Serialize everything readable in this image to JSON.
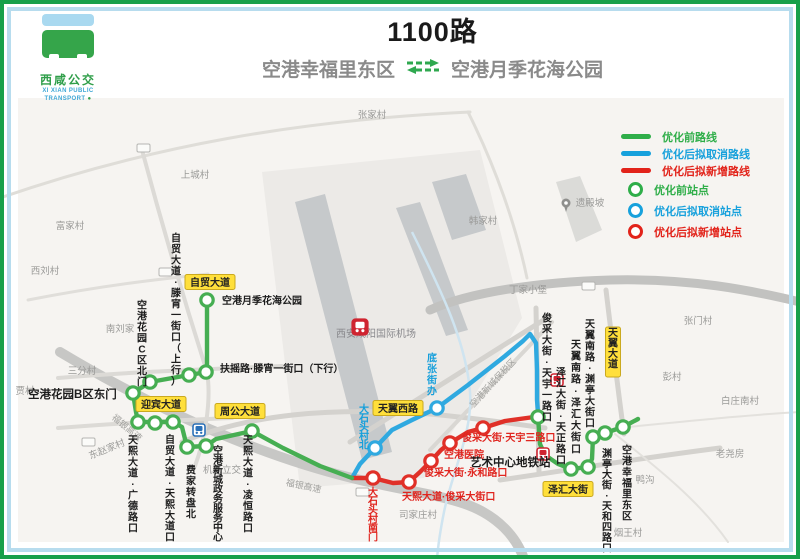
{
  "header": {
    "title": "1100路",
    "from": "空港幸福里东区",
    "to": "空港月季花海公园",
    "arrow_icon": "double-arrow-icon",
    "logo": {
      "cn": "西咸公交",
      "en_line1": "XI XIAN PUBLIC",
      "en_line2": "TRANSPORT"
    }
  },
  "legend": {
    "items": [
      {
        "type": "line",
        "color": "#2fae49",
        "label": "优化前路线"
      },
      {
        "type": "line",
        "color": "#17a1dc",
        "label": "优化后拟取消路线"
      },
      {
        "type": "line",
        "color": "#e2231a",
        "label": "优化后拟新增路线"
      },
      {
        "type": "stop",
        "color": "#2fae49",
        "label": "优化前站点"
      },
      {
        "type": "stop",
        "color": "#17a1dc",
        "label": "优化后拟取消站点"
      },
      {
        "type": "stop",
        "color": "#e2231a",
        "label": "优化后拟新增站点"
      }
    ]
  },
  "map": {
    "colors": {
      "bg": "#f6f4f1",
      "green_route": "#46ae52",
      "blue_route": "#2fa9e0",
      "red_route": "#e03028",
      "label_black": "#1c1c1c",
      "label_red": "#e0251f",
      "label_blue": "#169fdb",
      "yellow_bg": "#ffdf3b",
      "yellow_border": "#caa91f"
    },
    "routes": {
      "green_west": "207,300 207,372 189,375 150,382 133,393 136,412 138,422 173,422 182,427 187,447 206,446 216,439 252,431 283,448 320,466 352,478",
      "green_east": "538,417 540,444 545,455 558,464 571,469 588,467 592,459 593,437 605,433 623,427 638,419",
      "blue": "352,478 360,464 375,448 392,430 412,420 437,408 468,385 505,356 523,341 530,334 536,343 537,370 537,400 538,413",
      "red": "352,478 373,478 393,483 409,482 420,472 431,461 441,450 450,443 468,432 483,428 505,421 534,417"
    },
    "stops": {
      "green": [
        [
          207,
          300
        ],
        [
          206,
          372
        ],
        [
          189,
          375
        ],
        [
          150,
          382
        ],
        [
          133,
          393
        ],
        [
          138,
          422
        ],
        [
          155,
          423
        ],
        [
          173,
          422
        ],
        [
          187,
          447
        ],
        [
          206,
          446
        ],
        [
          252,
          431
        ],
        [
          538,
          417
        ],
        [
          571,
          469
        ],
        [
          588,
          467
        ],
        [
          593,
          437
        ],
        [
          605,
          433
        ],
        [
          623,
          427
        ]
      ],
      "blue": [
        [
          375,
          448
        ],
        [
          437,
          408
        ]
      ],
      "red": [
        [
          373,
          478
        ],
        [
          409,
          482
        ],
        [
          431,
          461
        ],
        [
          450,
          443
        ],
        [
          483,
          428
        ]
      ]
    },
    "stop_labels": [
      {
        "t": "空港月季花海公园",
        "x": 222,
        "y": 304,
        "o": "h",
        "c": "k"
      },
      {
        "t": "扶摇路·滕宵一街口（下行）",
        "x": 220,
        "y": 372,
        "o": "h",
        "c": "k"
      },
      {
        "t": "自贸大道·滕宵一街口（上行）",
        "x": 176,
        "y": 232,
        "o": "v",
        "c": "k",
        "ch": 11
      },
      {
        "t": "空港花园C区北门",
        "x": 142,
        "y": 299,
        "o": "v",
        "c": "k",
        "ch": 11
      },
      {
        "t": "空港花园B区东门",
        "x": 28,
        "y": 398,
        "o": "h",
        "c": "k",
        "big": 1
      },
      {
        "t": "天熙大道·广德路口",
        "x": 133,
        "y": 434,
        "o": "v",
        "c": "k",
        "ch": 11
      },
      {
        "t": "自贸大道·天熙大道口",
        "x": 170,
        "y": 434,
        "o": "v",
        "c": "k",
        "ch": 10.8
      },
      {
        "t": "费家转盘北",
        "x": 191,
        "y": 464,
        "o": "v",
        "c": "k",
        "ch": 11
      },
      {
        "t": "空港新城政务服务中心",
        "x": 218,
        "y": 446,
        "o": "v",
        "c": "k",
        "ch": 9.6
      },
      {
        "t": "天熙大道·凌恒路口",
        "x": 248,
        "y": 434,
        "o": "v",
        "c": "k",
        "ch": 11
      },
      {
        "t": "大石头村北",
        "x": 364,
        "y": 405,
        "o": "v",
        "c": "b",
        "ch": 9
      },
      {
        "t": "底张街办",
        "x": 432,
        "y": 352,
        "o": "v",
        "c": "b",
        "ch": 11
      },
      {
        "t": "大石头村南门",
        "x": 373,
        "y": 488,
        "o": "v",
        "c": "r",
        "ch": 9
      },
      {
        "t": "天熙大道·俊采大街口",
        "x": 402,
        "y": 500,
        "o": "h",
        "c": "r"
      },
      {
        "t": "俊采大街·永和路口",
        "x": 424,
        "y": 476,
        "o": "h",
        "c": "r"
      },
      {
        "t": "空港医院",
        "x": 444,
        "y": 458,
        "o": "h",
        "c": "r"
      },
      {
        "t": "俊采大街·天宇三路口",
        "x": 462,
        "y": 441,
        "o": "h",
        "c": "r"
      },
      {
        "t": "艺术中心地铁站",
        "x": 470,
        "y": 466,
        "o": "h",
        "c": "k",
        "big": 1
      },
      {
        "t": "俊采大街·天宇一路口",
        "x": 547,
        "y": 312,
        "o": "v",
        "c": "k",
        "ch": 11
      },
      {
        "t": "泽汇大街·天正路口",
        "x": 561,
        "y": 366,
        "o": "v",
        "c": "k",
        "ch": 11
      },
      {
        "t": "天翼南路·泽汇大街口",
        "x": 576,
        "y": 338,
        "o": "v",
        "c": "k",
        "ch": 11.6
      },
      {
        "t": "天翼南路·渊亭大街口",
        "x": 590,
        "y": 318,
        "o": "v",
        "c": "k",
        "ch": 11
      },
      {
        "t": "渊亭大街·天和四路口",
        "x": 607,
        "y": 448,
        "o": "v",
        "c": "k",
        "ch": 10.5
      },
      {
        "t": "空港幸福里东区",
        "x": 627,
        "y": 444,
        "o": "v",
        "c": "k",
        "ch": 11
      }
    ],
    "road_labels": [
      {
        "t": "自贸大道",
        "x": 210,
        "y": 282,
        "v": 0
      },
      {
        "t": "迎宾大道",
        "x": 161,
        "y": 404,
        "v": 0
      },
      {
        "t": "周公大道",
        "x": 240,
        "y": 411,
        "v": 0
      },
      {
        "t": "天翼西路",
        "x": 398,
        "y": 408,
        "v": 0
      },
      {
        "t": "泽汇大街",
        "x": 568,
        "y": 489,
        "v": 0
      },
      {
        "t": "天翼大道",
        "x": 613,
        "y": 332,
        "v": 1
      }
    ],
    "villages": [
      {
        "t": "张家村",
        "x": 372,
        "y": 118
      },
      {
        "t": "上城村",
        "x": 195,
        "y": 178
      },
      {
        "t": "富家村",
        "x": 70,
        "y": 229
      },
      {
        "t": "西刘村",
        "x": 45,
        "y": 274
      },
      {
        "t": "南刘家",
        "x": 120,
        "y": 332
      },
      {
        "t": "三分村",
        "x": 82,
        "y": 374
      },
      {
        "t": "贾村",
        "x": 25,
        "y": 394
      },
      {
        "t": "东赵家村",
        "x": 108,
        "y": 452,
        "rot": -22
      },
      {
        "t": "韩家村",
        "x": 483,
        "y": 224
      },
      {
        "t": "丁家小堡",
        "x": 528,
        "y": 293
      },
      {
        "t": "张门村",
        "x": 698,
        "y": 324
      },
      {
        "t": "彭村",
        "x": 672,
        "y": 380
      },
      {
        "t": "白庄南村",
        "x": 740,
        "y": 404
      },
      {
        "t": "老尧房",
        "x": 730,
        "y": 457
      },
      {
        "t": "鸭沟",
        "x": 645,
        "y": 483
      },
      {
        "t": "烟王村",
        "x": 628,
        "y": 536
      },
      {
        "t": "司家庄村",
        "x": 418,
        "y": 518
      },
      {
        "t": "机场立交",
        "x": 222,
        "y": 473
      },
      {
        "t": "遗殿坡",
        "x": 590,
        "y": 206,
        "poi": 1
      },
      {
        "t": "西安咸阳国际机场",
        "x": 376,
        "y": 337,
        "dark": 1
      }
    ],
    "rotated_labels": [
      {
        "t": "福银高速",
        "x": 125,
        "y": 430,
        "rot": 40
      },
      {
        "t": "福银高速",
        "x": 303,
        "y": 489,
        "rot": 12
      },
      {
        "t": "空港新城保税区",
        "x": 495,
        "y": 385,
        "rot": -47
      }
    ],
    "metro_icons": [
      {
        "x": 199,
        "y": 430,
        "c": "#2a70b8"
      },
      {
        "x": 557,
        "y": 380,
        "c": "#cf2430"
      },
      {
        "x": 543,
        "y": 454,
        "c": "#cf2430"
      }
    ],
    "airport_icon": {
      "x": 360,
      "y": 327,
      "c": "#cf2430"
    },
    "pin_icon": {
      "x": 566,
      "y": 203
    },
    "shields": [
      [
        143,
        148
      ],
      [
        165,
        272
      ],
      [
        88,
        442
      ],
      [
        588,
        286
      ],
      [
        362,
        492
      ]
    ],
    "roads": [
      {
        "d": "M0,198 C150,146 300,120 470,112",
        "w": 3,
        "c": "#dfddd8"
      },
      {
        "d": "M468,112 C496,168 516,226 527,278",
        "w": 3,
        "c": "#dfddd8"
      },
      {
        "d": "M430,310 C470,292 540,282 610,280 C690,278 750,290 800,302",
        "w": 9,
        "c": "#c2c2c0"
      },
      {
        "d": "M60,352 C160,412 262,456 352,478 C400,490 438,494 468,505 C497,516 516,536 524,559",
        "w": 10,
        "c": "#c7c7c5"
      },
      {
        "d": "M182,442 C250,414 330,407 430,414 C475,418 515,424 545,428",
        "w": 5,
        "c": "#d4d2ce"
      },
      {
        "d": "M350,442 L550,316",
        "w": 5,
        "c": "#d4d2ce"
      },
      {
        "d": "M430,450 L552,322",
        "w": 4,
        "c": "#d9d7d3"
      },
      {
        "d": "M142,150 C172,262 200,350 207,372 C212,402 204,442 195,466",
        "w": 4,
        "c": "#dcdad6"
      },
      {
        "d": "M58,378 C130,372 190,370 282,366",
        "w": 4,
        "c": "#dcdad6"
      },
      {
        "d": "M58,428 C120,423 180,420 232,418",
        "w": 4,
        "c": "#dcdad6"
      },
      {
        "d": "M536,308 L539,472",
        "w": 5,
        "c": "#d4d2ce"
      },
      {
        "d": "M500,480 C570,470 640,458 720,448",
        "w": 5,
        "c": "#d4d2ce"
      },
      {
        "d": "M606,290 C612,340 618,390 624,434",
        "w": 5,
        "c": "#d4d2ce"
      },
      {
        "d": "M28,300 C110,284 170,278 208,274",
        "w": 3,
        "c": "#e0deda"
      },
      {
        "d": "M615,434 C660,470 700,502 728,542",
        "w": 2,
        "c": "#e3e1dd"
      },
      {
        "d": "M628,427 C700,420 760,414 800,412",
        "w": 2,
        "c": "#e3e1dd"
      }
    ],
    "stream": {
      "d": "M412,232 C442,292 466,342 470,392 C473,432 452,472 444,512 C440,532 438,546 437,559",
      "w": 2.5,
      "c": "#cfe4f0"
    },
    "areas": [
      {
        "pts": "262,172 480,150 522,318 424,478 300,488",
        "c": "#eceae7"
      },
      {
        "pts": "295,202 325,194 392,452 362,460",
        "c": "#c6c9cb"
      },
      {
        "pts": "396,208 420,202 468,330 446,336",
        "c": "#c6c9cb"
      },
      {
        "pts": "432,182 466,174 486,230 452,240",
        "c": "#c6c9cb"
      },
      {
        "pts": "556,182 580,176 602,230 576,242",
        "c": "#dbdbd8"
      }
    ]
  }
}
